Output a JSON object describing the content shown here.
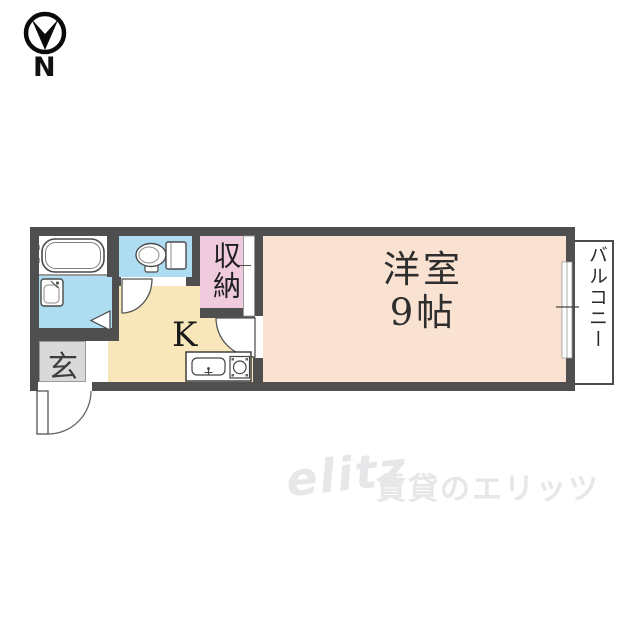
{
  "compass": {
    "north_label": "N"
  },
  "rooms": {
    "main_room": {
      "name": "洋室",
      "size": "9帖"
    },
    "kitchen": {
      "label": "K"
    },
    "storage": {
      "label": "収納"
    },
    "entrance": {
      "label": "玄"
    },
    "balcony": {
      "label": "バルコニー"
    }
  },
  "fixtures": {
    "bath": "bathtub",
    "washroom": "washbasin",
    "toilet": "toilet",
    "kitchen": "sink-and-gas-stove"
  },
  "colors": {
    "wall": "#4f4f4f",
    "main_room_floor": "#f9e2d2",
    "kitchen_floor": "#f7e7bb",
    "wet_area_floor": "#aedcf1",
    "storage_floor": "#f0cadd",
    "entrance_floor": "#d9d9d9"
  },
  "watermark": {
    "logo": "elitz",
    "text": "賃貸のエリッツ"
  }
}
